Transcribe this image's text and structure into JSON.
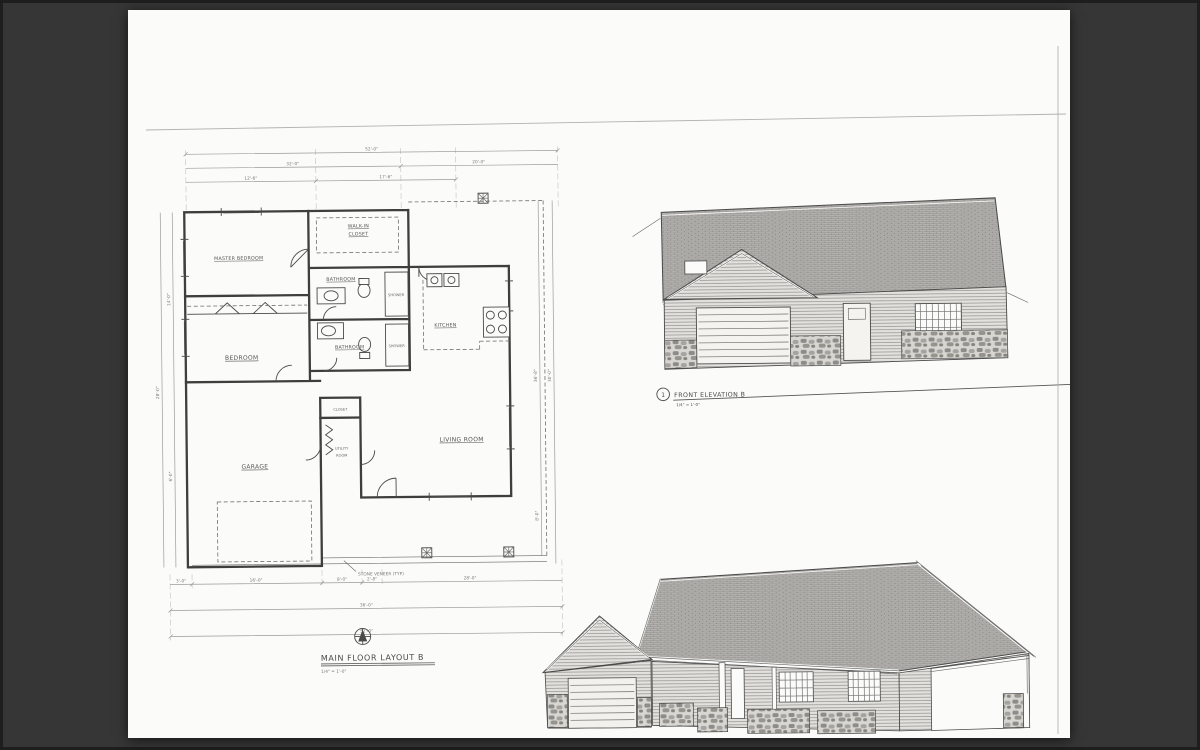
{
  "colors": {
    "background": "#363636",
    "paper": "#fbfbf9",
    "ink": "#3e3e3e",
    "dim_line": "#9b9b9b"
  },
  "floor_plan": {
    "title": "MAIN FLOOR LAYOUT B",
    "scale": "1/4\" = 1'-0\"",
    "rooms": {
      "master_bedroom": "MASTER BEDROOM",
      "walk_in_closet_line1": "WALK-IN",
      "walk_in_closet_line2": "CLOSET",
      "bathroom_master": "BATHROOM",
      "shower_master": "SHOWER",
      "bathroom_hall": "BATHROOM",
      "shower_hall": "SHOWER",
      "bedroom": "BEDROOM",
      "kitchen": "KITCHEN",
      "hall_closet": "CLOSET",
      "utility_line1": "UTILITY",
      "utility_line2": "ROOM",
      "garage": "GARAGE",
      "living_room": "LIVING ROOM"
    },
    "annotations": {
      "stone_veneer": "STONE VENEER (TYP)"
    },
    "dimensions": {
      "top": [
        "52'-0\"",
        "32'-0\"",
        "20'-0\"",
        "12'-6\"",
        "17'-6\""
      ],
      "bottom": [
        "3'-0\"",
        "16'-0\"",
        "8'-0\"",
        "2'-8\"",
        "28'-0\"",
        "36'-0\"",
        "52'-0\""
      ],
      "left": [
        "28'-0\"",
        "14'-0\"",
        "6'-0\""
      ],
      "right": [
        "36'-8\"",
        "30'-0\"",
        "8'-0\""
      ]
    }
  },
  "front_elevation": {
    "detail_number": "1",
    "title": "FRONT ELEVATION B",
    "scale": "1/4\" = 1'-0\""
  }
}
